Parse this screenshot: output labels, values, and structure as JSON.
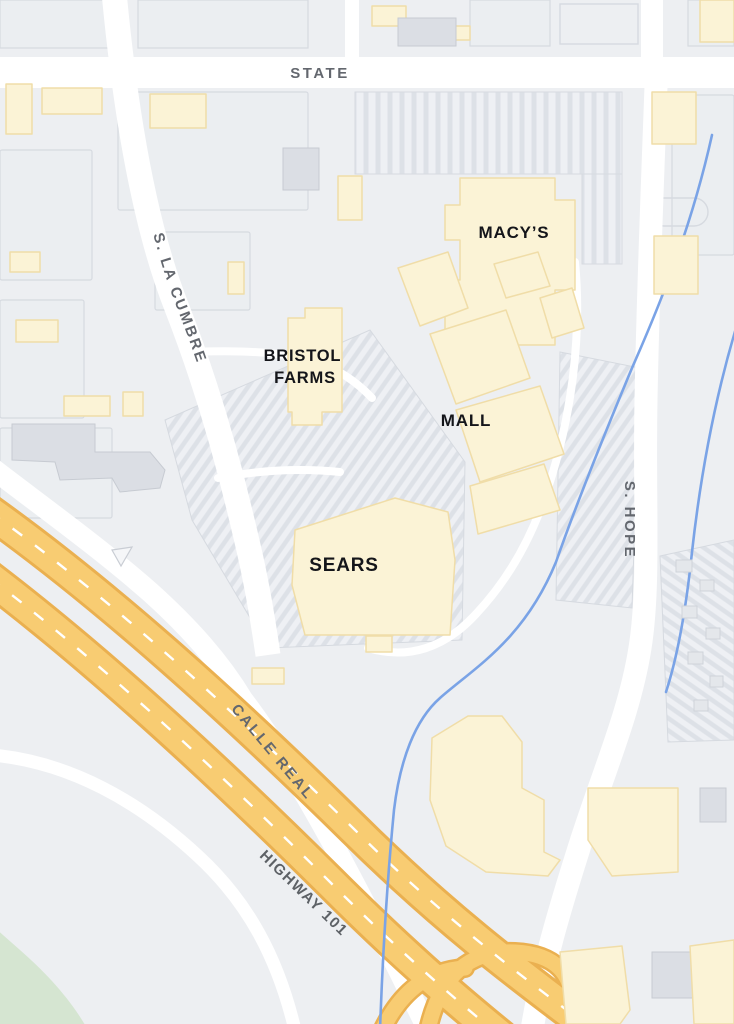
{
  "labels": {
    "state": "STATE",
    "la_cumbre": "S. LA CUMBRE",
    "s_hope": "S. HOPE",
    "calle_real": "CALLE REAL",
    "highway_101": "HIGHWAY 101",
    "macys": "MACY’S",
    "bristol_line1": "BRISTOL",
    "bristol_line2": "FARMS",
    "mall": "MALL",
    "sears": "SEARS"
  },
  "colors": {
    "background": "#edeff2",
    "road": "#ffffff",
    "road_label": "#63676e",
    "place_label": "#14151a",
    "building_fill": "#fbf3d6",
    "building_stroke": "#f0dda8",
    "highway_fill": "#f8cc72",
    "highway_stroke": "#eab050",
    "creek": "#7aa3e6",
    "park": "#d5e5d1",
    "block_line": "#d6dae0"
  }
}
